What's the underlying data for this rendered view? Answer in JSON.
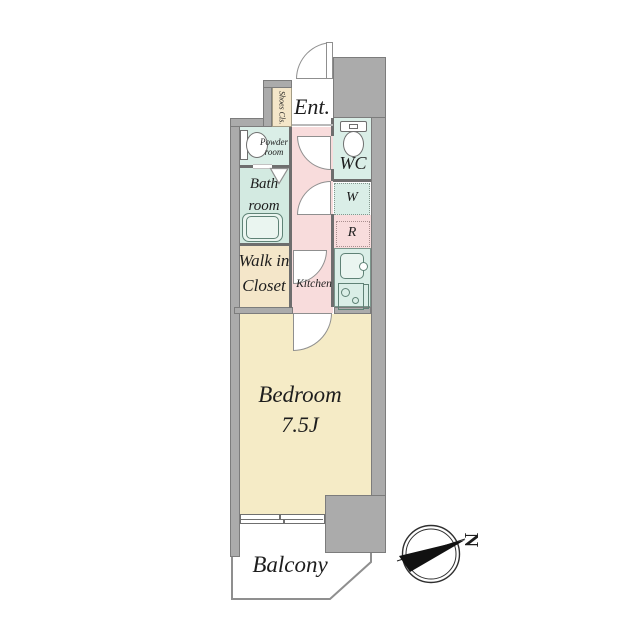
{
  "plan_title": "apartment-floor-plan",
  "rooms": {
    "entrance": {
      "label": "Ent."
    },
    "shoes_closet": {
      "label": "Shoes Cls."
    },
    "powder_room": {
      "line1": "Powder",
      "line2": "room"
    },
    "wc": {
      "label": "WC"
    },
    "washer_space": {
      "label": "W"
    },
    "refrigerator_space": {
      "label": "R"
    },
    "bath_room": {
      "line1": "Bath",
      "line2": "room"
    },
    "walk_in_closet": {
      "line1": "Walk in",
      "line2": "Closet"
    },
    "kitchen": {
      "label": "Kitchen"
    },
    "bedroom": {
      "label": "Bedroom",
      "size": "7.5J"
    },
    "balcony": {
      "label": "Balcony"
    }
  },
  "compass": {
    "label": "N"
  },
  "icons": {
    "toilet": "css-shape",
    "washbasin": "css-shape",
    "bathtub": "css-shape",
    "kitchen_sink": "css-shape",
    "stove": "css-shape",
    "entrance_door": "css-arc",
    "room_doors": "css-arc",
    "sliding_window": "css-shape",
    "compass_needle": "svg-shape"
  },
  "colors": {
    "wall": "#ababab",
    "walledge": "#7c7c7c",
    "line": "#6e6e6e",
    "beige": "#f5ebc6",
    "beigelight": "#f4e6c9",
    "green": "#daeee7",
    "greenbath": "#d3eae1",
    "pink": "#f8dcdc",
    "fixture": "#5f8276",
    "text": "#1d1d1d"
  }
}
